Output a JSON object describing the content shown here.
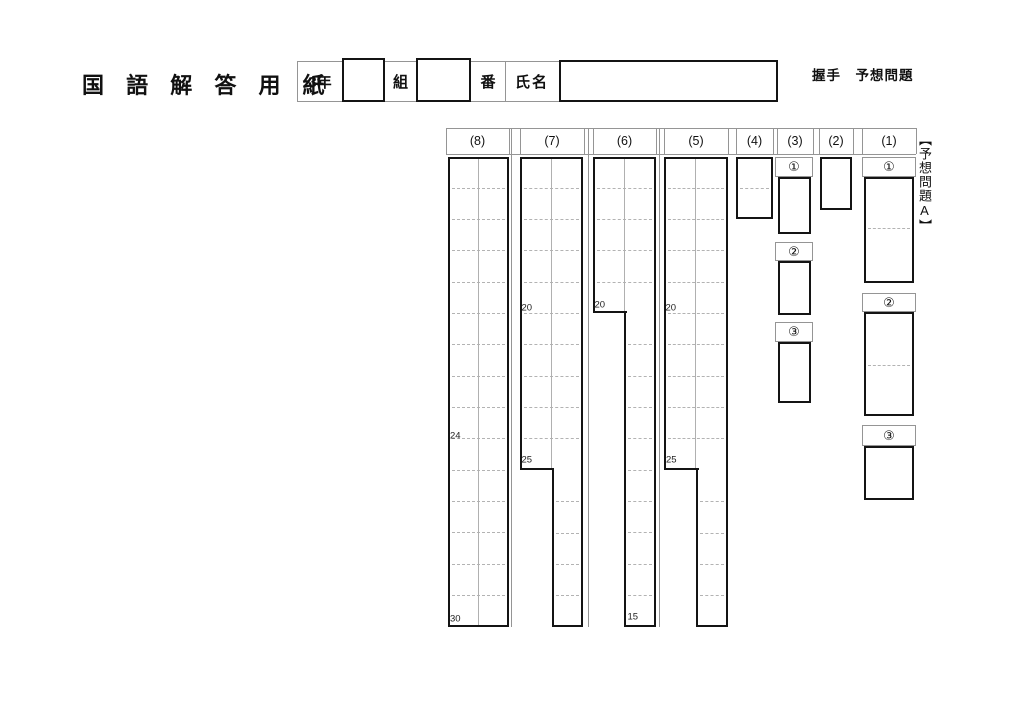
{
  "page": {
    "title": "国 語 解 答 用 紙",
    "exam_title": "握手　予想問題",
    "side_label": "【予想問題A】"
  },
  "name_bar": {
    "grade": "3年",
    "class": "組",
    "number": "番",
    "name": "氏名"
  },
  "grid": {
    "headers": [
      "(8)",
      "(7)",
      "(6)",
      "(5)",
      "(4)",
      "(3)",
      "(2)",
      "(1)"
    ],
    "marks": {
      "c8_24": "24",
      "c8_30": "30",
      "c7_20": "20",
      "c7_25": "25",
      "c6_20": "20",
      "c6_15": "15",
      "c5_20": "20",
      "c5_25": "25"
    },
    "c3_subs": [
      "①",
      "②",
      "③"
    ],
    "c1_subs": [
      "①",
      "②",
      "③"
    ]
  },
  "colors": {
    "line_thick": "#141414",
    "line_thin": "#959595",
    "dash_gray": "#b3b3b3"
  }
}
